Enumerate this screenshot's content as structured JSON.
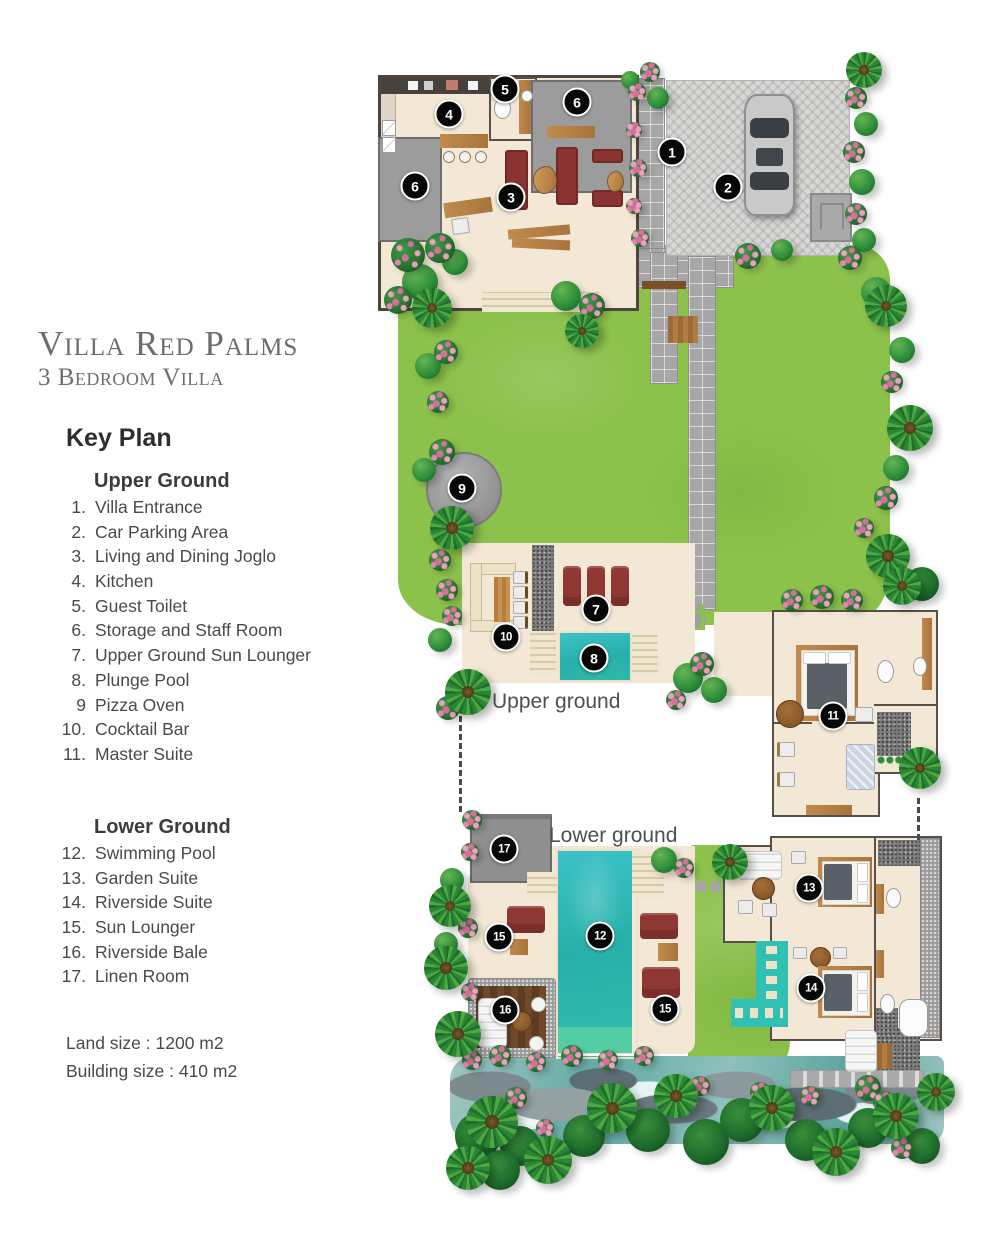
{
  "title": "Villa Red Palms",
  "subtitle": "3 Bedroom Villa",
  "key_plan": {
    "heading": "Key Plan",
    "sections": [
      {
        "name": "Upper Ground",
        "items": [
          {
            "num": "1.",
            "label": "Villa Entrance"
          },
          {
            "num": "2.",
            "label": "Car Parking Area"
          },
          {
            "num": "3.",
            "label": "Living and Dining Joglo"
          },
          {
            "num": "4.",
            "label": "Kitchen"
          },
          {
            "num": "5.",
            "label": "Guest Toilet"
          },
          {
            "num": "6.",
            "label": "Storage and Staff Room"
          },
          {
            "num": "7.",
            "label": "Upper Ground Sun Lounger"
          },
          {
            "num": "8.",
            "label": "Plunge Pool"
          },
          {
            "num": "9",
            "label": "Pizza Oven"
          },
          {
            "num": "10.",
            "label": "Cocktail Bar"
          },
          {
            "num": "11.",
            "label": "Master Suite"
          }
        ]
      },
      {
        "name": "Lower Ground",
        "items": [
          {
            "num": "12.",
            "label": "Swimming Pool"
          },
          {
            "num": "13.",
            "label": "Garden Suite"
          },
          {
            "num": "14.",
            "label": "Riverside Suite"
          },
          {
            "num": "15.",
            "label": "Sun Lounger"
          },
          {
            "num": "16.",
            "label": "Riverside Bale"
          },
          {
            "num": "17.",
            "label": "Linen Room"
          }
        ]
      }
    ]
  },
  "footer": {
    "land_size": "Land size : 1200 m2",
    "building_size": "Building size : 410 m2"
  },
  "plan": {
    "upper_label": "Upper ground",
    "lower_label": "Lower ground",
    "markers": [
      {
        "label": "1",
        "x": 672,
        "y": 152
      },
      {
        "label": "2",
        "x": 728,
        "y": 187
      },
      {
        "label": "3",
        "x": 511,
        "y": 197
      },
      {
        "label": "4",
        "x": 449,
        "y": 114
      },
      {
        "label": "5",
        "x": 505,
        "y": 89
      },
      {
        "label": "6",
        "x": 577,
        "y": 102
      },
      {
        "label": "6",
        "x": 415,
        "y": 186
      },
      {
        "label": "7",
        "x": 596,
        "y": 609
      },
      {
        "label": "8",
        "x": 594,
        "y": 658
      },
      {
        "label": "9",
        "x": 462,
        "y": 488
      },
      {
        "label": "10",
        "x": 506,
        "y": 637
      },
      {
        "label": "11",
        "x": 833,
        "y": 716
      },
      {
        "label": "12",
        "x": 600,
        "y": 936
      },
      {
        "label": "13",
        "x": 809,
        "y": 888
      },
      {
        "label": "14",
        "x": 811,
        "y": 988
      },
      {
        "label": "15",
        "x": 499,
        "y": 937
      },
      {
        "label": "15",
        "x": 665,
        "y": 1009
      },
      {
        "label": "16",
        "x": 505,
        "y": 1010
      },
      {
        "label": "17",
        "x": 504,
        "y": 849
      }
    ]
  },
  "colors": {
    "lawn": "#8cc14c",
    "pool": "#2db7b5",
    "pond": "#31c0b4",
    "marker_bg": "#070707",
    "title_gray": "#6d6d6d",
    "red_furniture": "#8a3330"
  }
}
